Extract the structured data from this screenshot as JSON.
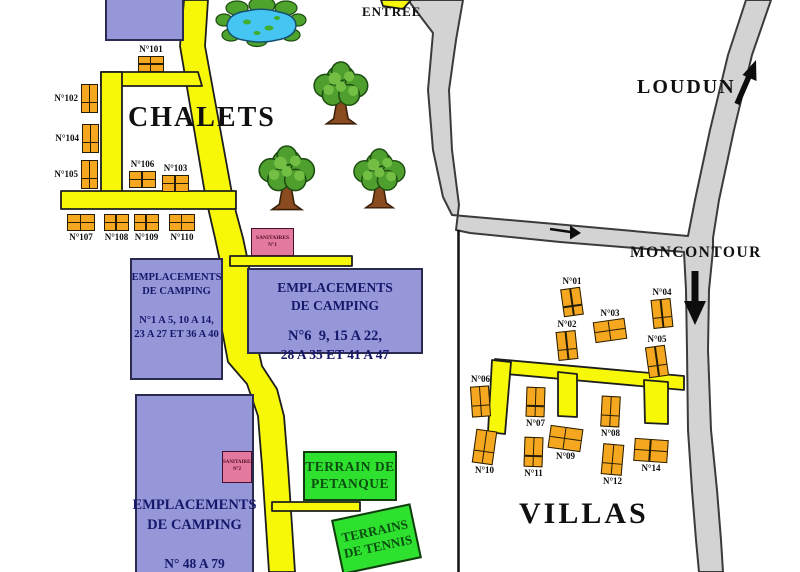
{
  "labels": {
    "entree": "ENTREE",
    "loudun": "LOUDUN",
    "moncontour": "MONCONTOUR",
    "chalets": "CHALETS",
    "villas": "VILLAS"
  },
  "camping_zones": [
    {
      "line1": "EMPLACEMENTS",
      "line2": "DE CAMPING",
      "line3": "N°1 A 5, 10 A 14,",
      "line4": "23 A 27 ET 36 A 40"
    },
    {
      "line1": "EMPLACEMENTS",
      "line2": "DE CAMPING",
      "line3": "N°6  9, 15 A 22,",
      "line4": "28 A 35 ET 41 A 47"
    },
    {
      "line1": "EMPLACEMENTS",
      "line2": "DE CAMPING",
      "line3": "N° 48 A 79",
      "line4": ""
    }
  ],
  "sanitaires": [
    {
      "line1": "SANITAIRES",
      "line2": "N°1"
    },
    {
      "line1": "SANITAIRES",
      "line2": "N°2"
    }
  ],
  "sports": [
    {
      "line1": "TERRAIN DE",
      "line2": "PETANQUE"
    },
    {
      "line1": "TERRAINS",
      "line2": "DE TENNIS"
    }
  ],
  "chalets": [
    {
      "label": "N°101",
      "x": 138,
      "y": 56,
      "w": 26,
      "h": 16,
      "o": "h",
      "lp": "above",
      "rot": 0
    },
    {
      "label": "N°102",
      "x": 81,
      "y": 84,
      "w": 17,
      "h": 29,
      "o": "v",
      "lp": "left",
      "rot": 0
    },
    {
      "label": "N°103",
      "x": 162,
      "y": 175,
      "w": 27,
      "h": 17,
      "o": "h",
      "lp": "above",
      "rot": 0
    },
    {
      "label": "N°104",
      "x": 82,
      "y": 124,
      "w": 17,
      "h": 29,
      "o": "v",
      "lp": "left",
      "rot": 0
    },
    {
      "label": "N°105",
      "x": 81,
      "y": 160,
      "w": 17,
      "h": 29,
      "o": "v",
      "lp": "left",
      "rot": 0
    },
    {
      "label": "N°106",
      "x": 129,
      "y": 171,
      "w": 27,
      "h": 17,
      "o": "h",
      "lp": "above",
      "rot": 0
    },
    {
      "label": "N°107",
      "x": 67,
      "y": 214,
      "w": 28,
      "h": 17,
      "o": "h",
      "lp": "below",
      "rot": 0
    },
    {
      "label": "N°108",
      "x": 104,
      "y": 214,
      "w": 25,
      "h": 17,
      "o": "h",
      "lp": "below",
      "rot": 0
    },
    {
      "label": "N°109",
      "x": 134,
      "y": 214,
      "w": 25,
      "h": 17,
      "o": "h",
      "lp": "below",
      "rot": 0
    },
    {
      "label": "N°110",
      "x": 169,
      "y": 214,
      "w": 26,
      "h": 17,
      "o": "h",
      "lp": "below",
      "rot": 0
    }
  ],
  "villas": [
    {
      "label": "N°01",
      "x": 562,
      "y": 288,
      "w": 20,
      "h": 28,
      "o": "v",
      "lp": "above",
      "rot": -8
    },
    {
      "label": "N°02",
      "x": 557,
      "y": 331,
      "w": 20,
      "h": 29,
      "o": "v",
      "lp": "above",
      "rot": -6
    },
    {
      "label": "N°03",
      "x": 594,
      "y": 320,
      "w": 32,
      "h": 21,
      "o": "h",
      "lp": "above",
      "rot": -8
    },
    {
      "label": "N°04",
      "x": 652,
      "y": 299,
      "w": 20,
      "h": 29,
      "o": "v",
      "lp": "above",
      "rot": -6
    },
    {
      "label": "N°05",
      "x": 647,
      "y": 346,
      "w": 20,
      "h": 31,
      "o": "v",
      "lp": "above",
      "rot": -8
    },
    {
      "label": "N°06",
      "x": 471,
      "y": 386,
      "w": 19,
      "h": 31,
      "o": "v",
      "lp": "above",
      "rot": -4
    },
    {
      "label": "N°07",
      "x": 526,
      "y": 387,
      "w": 19,
      "h": 30,
      "o": "v",
      "lp": "below",
      "rot": 2
    },
    {
      "label": "N°08",
      "x": 601,
      "y": 396,
      "w": 19,
      "h": 31,
      "o": "v",
      "lp": "below",
      "rot": 3
    },
    {
      "label": "N°09",
      "x": 549,
      "y": 427,
      "w": 33,
      "h": 23,
      "o": "h",
      "lp": "below",
      "rot": 8
    },
    {
      "label": "N°10",
      "x": 474,
      "y": 430,
      "w": 21,
      "h": 34,
      "o": "v",
      "lp": "below",
      "rot": 8
    },
    {
      "label": "N°11",
      "x": 524,
      "y": 437,
      "w": 19,
      "h": 30,
      "o": "v",
      "lp": "below",
      "rot": 2
    },
    {
      "label": "N°12",
      "x": 602,
      "y": 444,
      "w": 21,
      "h": 31,
      "o": "v",
      "lp": "below",
      "rot": 5
    },
    {
      "label": "N°14",
      "x": 634,
      "y": 439,
      "w": 34,
      "h": 23,
      "o": "h",
      "lp": "below",
      "rot": 4
    }
  ],
  "colors": {
    "road_yellow": "#f7f708",
    "road_gray": "#d3d3d3",
    "building_orange": "#f5a81f",
    "zone_purple": "#9597d8",
    "zone_text_navy": "#17176b",
    "sanitaire_pink": "#e4799f",
    "sport_green": "#2fe12f",
    "sport_text_green": "#0b4d10",
    "pond_blue": "#45c6f2",
    "tree_green": "#4f9f2f"
  }
}
